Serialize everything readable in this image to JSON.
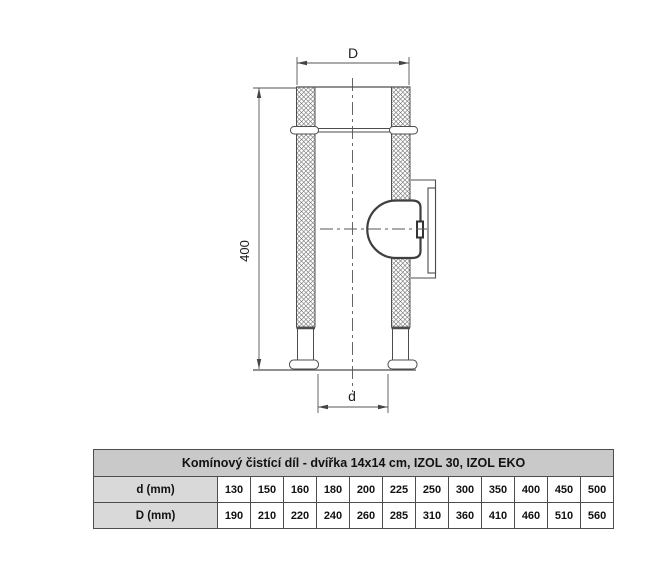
{
  "drawing": {
    "dim_outer_label": "D",
    "dim_length_label": "400",
    "dim_inner_label": "d"
  },
  "table": {
    "title": "Komínový čistící díl - dvířka 14x14 cm, IZOL 30, IZOL EKO",
    "rows": [
      {
        "label": "d (mm)",
        "values": [
          "130",
          "150",
          "160",
          "180",
          "200",
          "225",
          "250",
          "300",
          "350",
          "400",
          "450",
          "500"
        ]
      },
      {
        "label": "D (mm)",
        "values": [
          "190",
          "210",
          "220",
          "240",
          "260",
          "285",
          "310",
          "360",
          "410",
          "460",
          "510",
          "560"
        ]
      }
    ]
  },
  "colors": {
    "line": "#4d4d4d",
    "dim_line": "#555555",
    "hatch": "#6b6b6b",
    "table_header_bg": "#c9c9c9",
    "table_label_bg": "#d9d9d9",
    "table_border": "#4d4d4d"
  }
}
